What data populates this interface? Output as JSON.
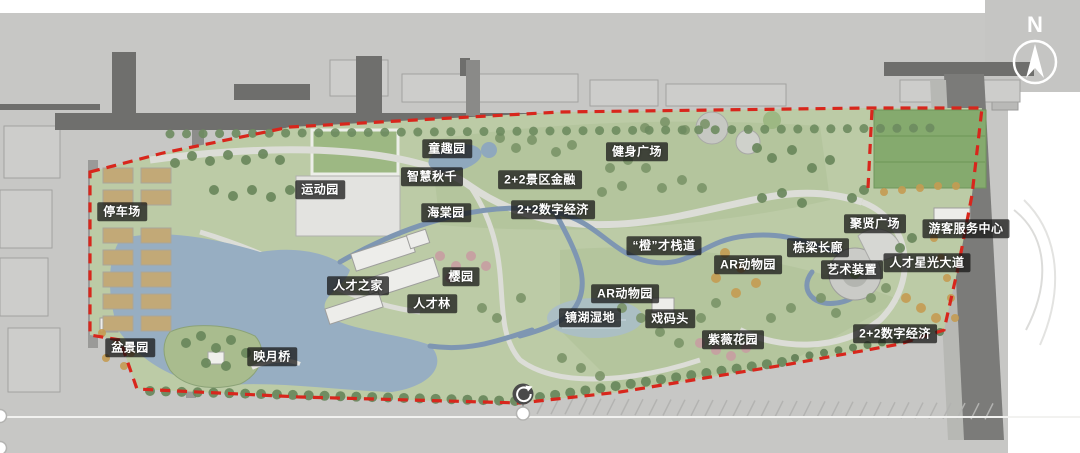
{
  "compass": {
    "label": "N"
  },
  "map": {
    "labels": [
      {
        "text": "童趣园",
        "x": 447,
        "y": 149
      },
      {
        "text": "智慧秋千",
        "x": 432,
        "y": 177
      },
      {
        "text": "2+2景区金融",
        "x": 540,
        "y": 180
      },
      {
        "text": "健身广场",
        "x": 637,
        "y": 152
      },
      {
        "text": "运动园",
        "x": 320,
        "y": 190
      },
      {
        "text": "海棠园",
        "x": 446,
        "y": 213
      },
      {
        "text": "2+2数字经济",
        "x": 553,
        "y": 210
      },
      {
        "text": "停车场",
        "x": 122,
        "y": 212
      },
      {
        "text": "“橙”才栈道",
        "x": 664,
        "y": 246
      },
      {
        "text": "AR动物园",
        "x": 748,
        "y": 265
      },
      {
        "text": "栋梁长廊",
        "x": 818,
        "y": 248
      },
      {
        "text": "聚贤广场",
        "x": 875,
        "y": 224
      },
      {
        "text": "游客服务中心",
        "x": 966,
        "y": 229
      },
      {
        "text": "艺术装置",
        "x": 852,
        "y": 270
      },
      {
        "text": "人才星光大道",
        "x": 927,
        "y": 263
      },
      {
        "text": "人才之家",
        "x": 358,
        "y": 286
      },
      {
        "text": "樱园",
        "x": 461,
        "y": 277
      },
      {
        "text": "人才林",
        "x": 432,
        "y": 304
      },
      {
        "text": "AR动物园",
        "x": 625,
        "y": 294
      },
      {
        "text": "镜湖湿地",
        "x": 590,
        "y": 318
      },
      {
        "text": "戏码头",
        "x": 670,
        "y": 319
      },
      {
        "text": "紫薇花园",
        "x": 733,
        "y": 340
      },
      {
        "text": "2+2数字经济",
        "x": 895,
        "y": 334
      },
      {
        "text": "盆景园",
        "x": 130,
        "y": 348
      },
      {
        "text": "映月桥",
        "x": 272,
        "y": 357
      }
    ]
  },
  "colors": {
    "boundary_red": "#d8261c",
    "water": "#97aec2",
    "label_bg": "rgba(22,22,22,0.74)",
    "map_gray": "#c7c7c5"
  }
}
